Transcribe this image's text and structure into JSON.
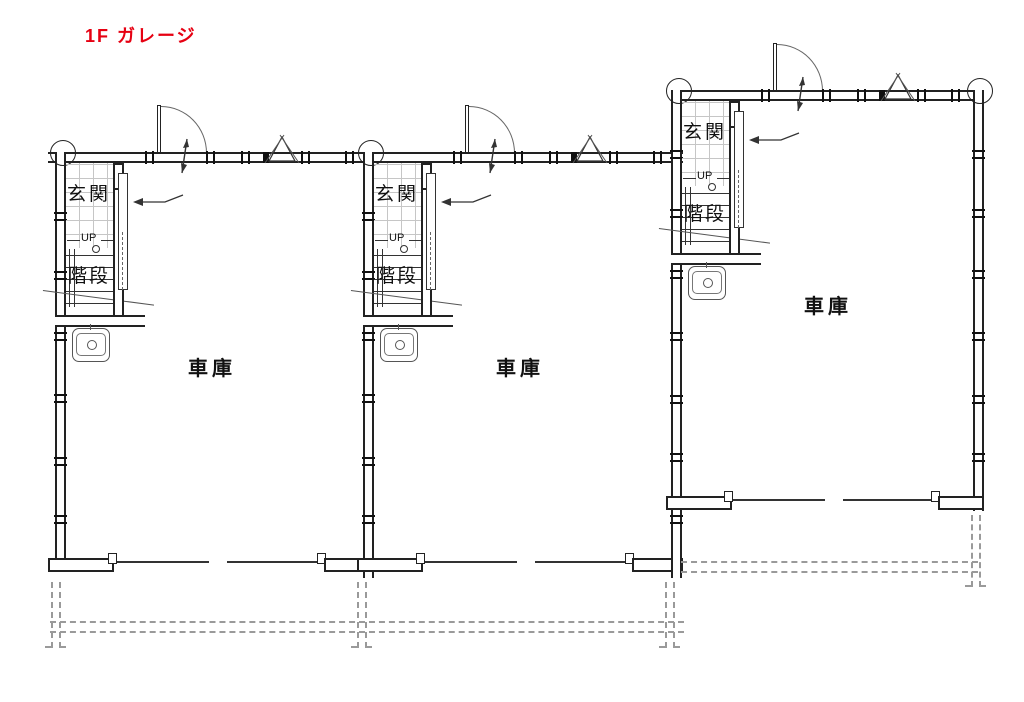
{
  "title": {
    "label": "1F ガレージ"
  },
  "colors": {
    "title_red": "#e60012",
    "wall_line": "#222222",
    "thin_line": "#333333",
    "overhang_dash": "#9a9a9a"
  },
  "units": [
    {
      "id": "unit-1",
      "labels": {
        "entrance": "玄関",
        "up": "UP",
        "stairs": "階段",
        "garage": "車庫"
      }
    },
    {
      "id": "unit-2",
      "labels": {
        "entrance": "玄関",
        "up": "UP",
        "stairs": "階段",
        "garage": "車庫"
      }
    },
    {
      "id": "unit-3",
      "labels": {
        "entrance": "玄関",
        "up": "UP",
        "stairs": "階段",
        "garage": "車庫"
      }
    }
  ]
}
